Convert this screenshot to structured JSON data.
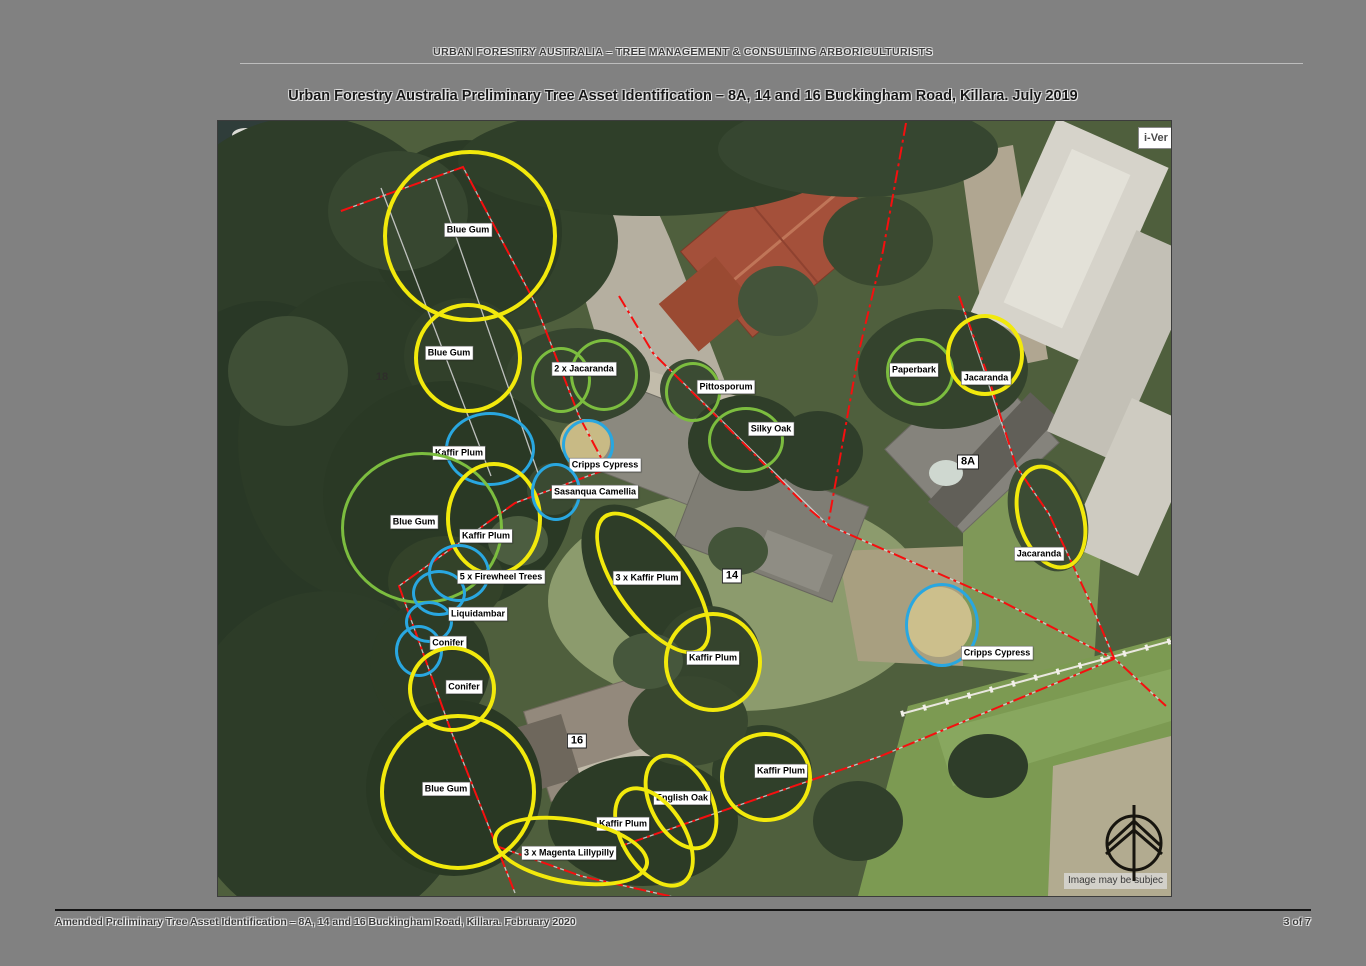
{
  "page": {
    "header": "URBAN FORESTRY AUSTRALIA – TREE MANAGEMENT & CONSULTING ARBORICULTURISTS",
    "title": "Urban Forestry Australia Preliminary Tree Asset Identification – 8A, 14 and 16 Buckingham Road, Killara. July 2019",
    "footer": "Amended Preliminary Tree Asset Identification – 8A, 14 and 16 Buckingham Road, Killara. February 2020",
    "page_number": "3 of 7"
  },
  "map": {
    "corner_button": "i-Ver",
    "attribution": "Image may be subjec",
    "colors": {
      "yellow": "#f2e90c",
      "green": "#7cbd3f",
      "blue": "#29a7e0",
      "boundary_red": "#f50f0f"
    },
    "house_numbers": [
      {
        "label": "8A",
        "x": 750,
        "y": 341,
        "boxed": true
      },
      {
        "label": "14",
        "x": 514,
        "y": 455,
        "boxed": true
      },
      {
        "label": "16",
        "x": 359,
        "y": 620,
        "boxed": true
      },
      {
        "label": "18",
        "x": 164,
        "y": 256,
        "boxed": false
      }
    ],
    "annotations": [
      {
        "label": "Blue Gum",
        "label_x": 250,
        "label_y": 109,
        "circles": [
          {
            "cx": 248,
            "cy": 111,
            "rx": 83,
            "ry": 82,
            "rot": 0,
            "color": "yellow"
          }
        ]
      },
      {
        "label": "Blue Gum",
        "label_x": 231,
        "label_y": 232,
        "circles": [
          {
            "cx": 246,
            "cy": 233,
            "rx": 50,
            "ry": 51,
            "rot": 0,
            "color": "yellow"
          }
        ]
      },
      {
        "label": "2 x Jacaranda",
        "label_x": 366,
        "label_y": 248,
        "circles": [
          {
            "cx": 340,
            "cy": 256,
            "rx": 27,
            "ry": 30,
            "rot": 0,
            "color": "green"
          },
          {
            "cx": 383,
            "cy": 251,
            "rx": 31,
            "ry": 33,
            "rot": 0,
            "color": "green"
          }
        ]
      },
      {
        "label": "Pittosporum",
        "label_x": 508,
        "label_y": 266,
        "circles": [
          {
            "cx": 472,
            "cy": 268,
            "rx": 25,
            "ry": 27,
            "rot": 0,
            "color": "green"
          }
        ]
      },
      {
        "label": "Silky Oak",
        "label_x": 553,
        "label_y": 308,
        "circles": [
          {
            "cx": 525,
            "cy": 316,
            "rx": 35,
            "ry": 30,
            "rot": 0,
            "color": "green"
          }
        ]
      },
      {
        "label": "Paperbark",
        "label_x": 696,
        "label_y": 249,
        "circles": [
          {
            "cx": 699,
            "cy": 248,
            "rx": 31,
            "ry": 31,
            "rot": 0,
            "color": "green"
          }
        ]
      },
      {
        "label": "Jacaranda",
        "label_x": 768,
        "label_y": 257,
        "circles": [
          {
            "cx": 763,
            "cy": 230,
            "rx": 35,
            "ry": 37,
            "rot": 0,
            "color": "yellow"
          }
        ]
      },
      {
        "label": "Kaffir Plum",
        "label_x": 241,
        "label_y": 332,
        "circles": [
          {
            "cx": 269,
            "cy": 325,
            "rx": 42,
            "ry": 34,
            "rot": 0,
            "color": "blue"
          }
        ]
      },
      {
        "label": "Blue Gum",
        "label_x": 196,
        "label_y": 401,
        "circles": [
          {
            "cx": 201,
            "cy": 404,
            "rx": 78,
            "ry": 73,
            "rot": 0,
            "color": "green"
          }
        ]
      },
      {
        "label": "Kaffir Plum",
        "label_x": 268,
        "label_y": 415,
        "circles": [
          {
            "cx": 272,
            "cy": 394,
            "rx": 44,
            "ry": 53,
            "rot": 0,
            "color": "yellow"
          }
        ]
      },
      {
        "label": "Cripps Cypress",
        "label_x": 387,
        "label_y": 344,
        "circles": [
          {
            "cx": 367,
            "cy": 321,
            "rx": 23,
            "ry": 23,
            "rot": 0,
            "color": "blue"
          }
        ]
      },
      {
        "label": "Sasanqua Camellia",
        "label_x": 377,
        "label_y": 371,
        "circles": [
          {
            "cx": 335,
            "cy": 368,
            "rx": 22,
            "ry": 26,
            "rot": 0,
            "color": "blue"
          }
        ]
      },
      {
        "label": "5 x Firewheel Trees",
        "label_x": 283,
        "label_y": 456,
        "circles": [
          {
            "cx": 238,
            "cy": 449,
            "rx": 28,
            "ry": 26,
            "rot": 0,
            "color": "blue"
          },
          {
            "cx": 218,
            "cy": 469,
            "rx": 24,
            "ry": 20,
            "rot": 0,
            "color": "blue"
          }
        ]
      },
      {
        "label": "Liquidambar",
        "label_x": 260,
        "label_y": 493,
        "circles": [
          {
            "cx": 208,
            "cy": 498,
            "rx": 21,
            "ry": 18,
            "rot": 0,
            "color": "blue"
          }
        ]
      },
      {
        "label": "Conifer",
        "label_x": 230,
        "label_y": 522,
        "circles": [
          {
            "cx": 198,
            "cy": 527,
            "rx": 21,
            "ry": 23,
            "rot": 0,
            "color": "blue"
          }
        ]
      },
      {
        "label": "Conifer",
        "label_x": 246,
        "label_y": 566,
        "circles": [
          {
            "cx": 230,
            "cy": 564,
            "rx": 40,
            "ry": 39,
            "rot": 0,
            "color": "yellow"
          }
        ]
      },
      {
        "label": "3 x Kaffir Plum",
        "label_x": 429,
        "label_y": 457,
        "circles": [
          {
            "cx": 431,
            "cy": 458,
            "rx": 33,
            "ry": 80,
            "rot": -36,
            "color": "yellow"
          }
        ]
      },
      {
        "label": "Kaffir Plum",
        "label_x": 495,
        "label_y": 537,
        "circles": [
          {
            "cx": 491,
            "cy": 537,
            "rx": 45,
            "ry": 46,
            "rot": 0,
            "color": "yellow"
          }
        ]
      },
      {
        "label": "Kaffir Plum",
        "label_x": 563,
        "label_y": 650,
        "circles": [
          {
            "cx": 544,
            "cy": 652,
            "rx": 42,
            "ry": 41,
            "rot": 0,
            "color": "yellow"
          }
        ]
      },
      {
        "label": "English Oak",
        "label_x": 464,
        "label_y": 677,
        "circles": [
          {
            "cx": 459,
            "cy": 677,
            "rx": 28,
            "ry": 48,
            "rot": -28,
            "color": "yellow"
          }
        ]
      },
      {
        "label": "Kaffir Plum",
        "label_x": 405,
        "label_y": 703,
        "circles": [
          {
            "cx": 432,
            "cy": 712,
            "rx": 29,
            "ry": 52,
            "rot": -32,
            "color": "yellow"
          }
        ]
      },
      {
        "label": "3 x Magenta Lillypilly",
        "label_x": 351,
        "label_y": 732,
        "circles": [
          {
            "cx": 349,
            "cy": 726,
            "rx": 75,
            "ry": 29,
            "rot": 10,
            "color": "yellow"
          }
        ]
      },
      {
        "label": "Blue Gum",
        "label_x": 228,
        "label_y": 668,
        "circles": [
          {
            "cx": 236,
            "cy": 667,
            "rx": 74,
            "ry": 74,
            "rot": 0,
            "color": "yellow"
          }
        ]
      },
      {
        "label": "Jacaranda",
        "label_x": 821,
        "label_y": 433,
        "circles": [
          {
            "cx": 829,
            "cy": 392,
            "rx": 30,
            "ry": 50,
            "rot": -18,
            "color": "yellow"
          }
        ]
      },
      {
        "label": "Cripps Cypress",
        "label_x": 779,
        "label_y": 532,
        "circles": [
          {
            "cx": 721,
            "cy": 501,
            "rx": 34,
            "ry": 39,
            "rot": 0,
            "color": "blue"
          }
        ]
      }
    ]
  }
}
